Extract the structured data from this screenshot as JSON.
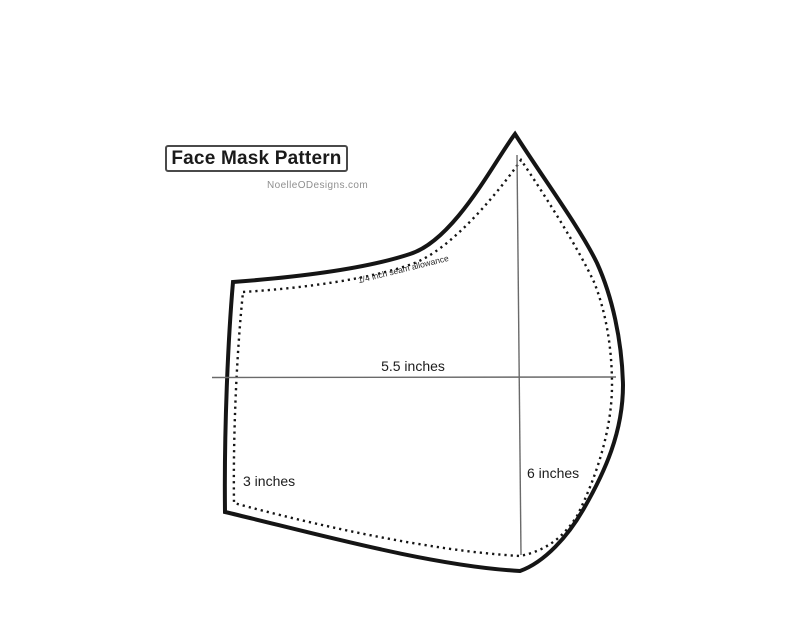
{
  "header": {
    "title": "Face Mask Pattern",
    "website": "NoelleODesigns.com"
  },
  "measurements": {
    "width_label": "5.5 inches",
    "height_label": "6 inches",
    "side_label": "3 inches",
    "seam_label": "1/4 inch seam allowance"
  },
  "colors": {
    "outline": "#151515",
    "stitch_line": "#151515",
    "measure_line": "#6a6a6a",
    "title_text": "#1a1a1a",
    "credit_text": "#8f8f8f",
    "background": "#ffffff"
  }
}
